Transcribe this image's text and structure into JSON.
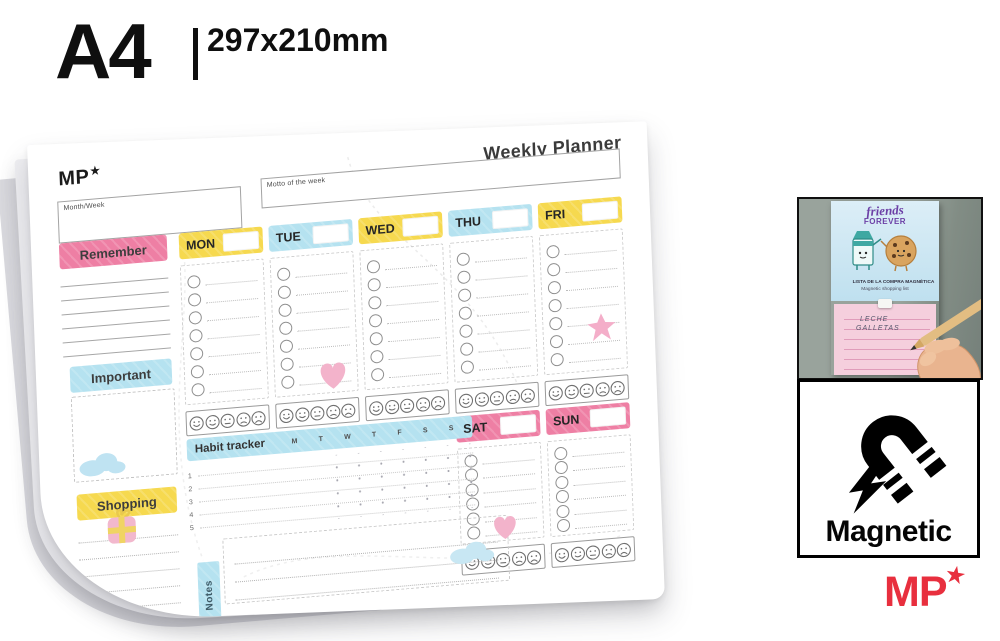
{
  "header": {
    "format": "A4",
    "dimensions": "297x210mm"
  },
  "colors": {
    "yellow": "#f6d94f",
    "blue": "#b5e2f0",
    "pink": "#ee7fa4",
    "red": "#e82f3e",
    "page": "#ffffff"
  },
  "planner": {
    "logo_text": "MP",
    "logo_star": "★",
    "title": "Weekly Planner",
    "month_week_label": "Month/Week",
    "motto_label": "Motto of the week",
    "sidebar": {
      "remember": "Remember",
      "important": "Important",
      "shopping": "Shopping"
    },
    "days": [
      {
        "label": "MON",
        "color": "yellow"
      },
      {
        "label": "TUE",
        "color": "blue"
      },
      {
        "label": "WED",
        "color": "yellow"
      },
      {
        "label": "THU",
        "color": "blue"
      },
      {
        "label": "FRI",
        "color": "yellow"
      },
      {
        "label": "SAT",
        "color": "pink"
      },
      {
        "label": "SUN",
        "color": "pink"
      }
    ],
    "habit_tracker": {
      "title": "Habit tracker",
      "day_letters": [
        "M",
        "T",
        "W",
        "T",
        "F",
        "S",
        "S"
      ],
      "row_numbers": [
        "1",
        "2",
        "3",
        "4",
        "5"
      ]
    },
    "notes_label": "Notes"
  },
  "photo": {
    "friends": "friends",
    "forever": "FOREVER",
    "caption_line1": "LISTA DE LA COMPRA MAGNÉTICA",
    "caption_line2": "Magnetic shopping list",
    "handwritten": [
      "LECHE",
      "GALLETAS"
    ]
  },
  "magnetic": {
    "label": "Magnetic"
  },
  "footer_logo": {
    "text": "MP",
    "star": "★"
  }
}
